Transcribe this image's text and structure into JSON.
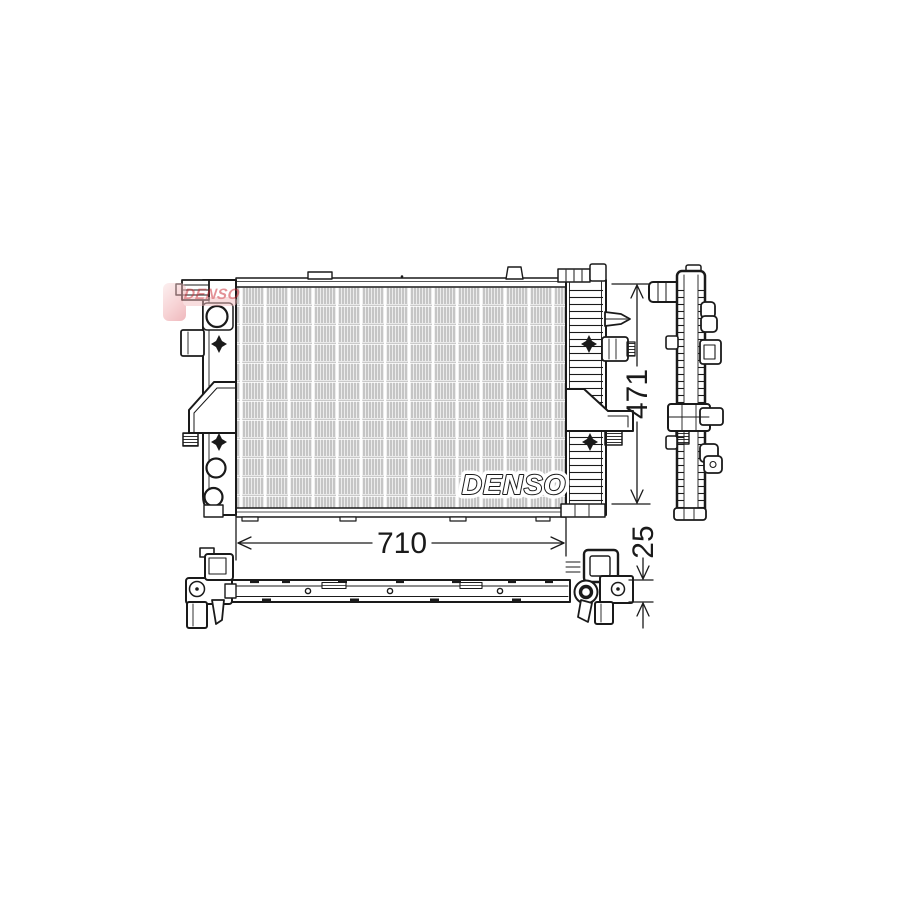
{
  "drawing_title": "Radiator technical line drawing, three views",
  "brand": {
    "logo_text": "DENSO",
    "watermark_text": "DENSO"
  },
  "dimensions": {
    "width": "710",
    "height": "471",
    "depth": "25"
  },
  "colors": {
    "line": "#1a1a1a",
    "core_fill": "#ececec",
    "core_stripe": "#a5a5a5",
    "logo_red": "#c8242e",
    "logo_pink": "#f0a9ad",
    "background": "#ffffff"
  }
}
